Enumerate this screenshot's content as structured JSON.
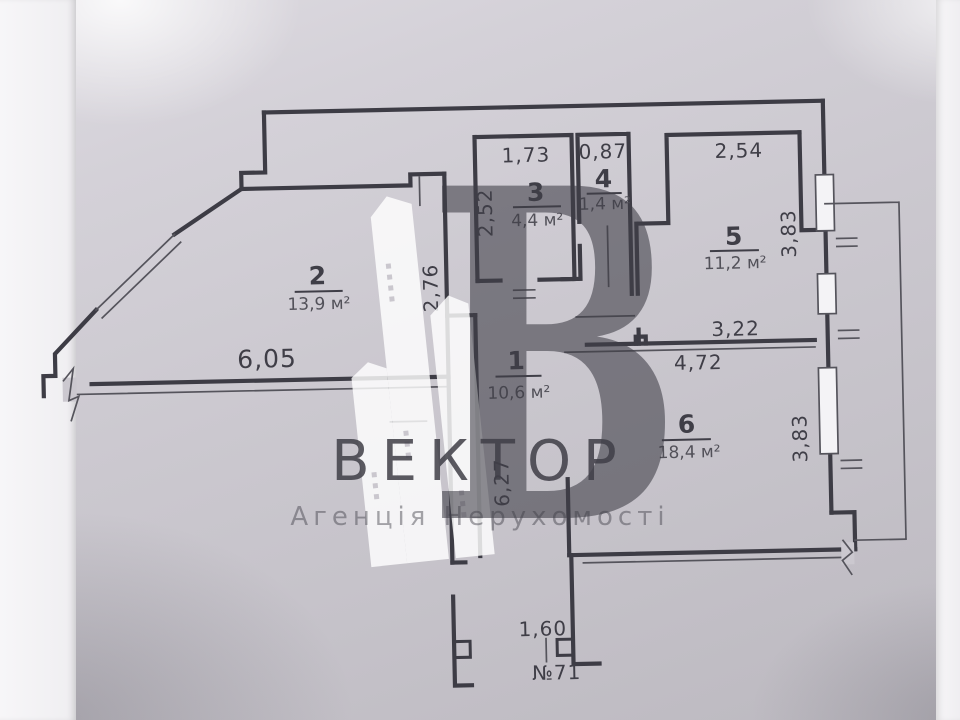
{
  "plan": {
    "apartment_label": "№71",
    "rooms": [
      {
        "number": "1",
        "area": "10,6 м²"
      },
      {
        "number": "2",
        "area": "13,9 м²"
      },
      {
        "number": "3",
        "area": "4,4 м²"
      },
      {
        "number": "4",
        "area": "1,4 м²"
      },
      {
        "number": "5",
        "area": "11,2 м²"
      },
      {
        "number": "6",
        "area": "18,4 м²"
      }
    ],
    "dimensions": {
      "room2_bottom_width": "6,05",
      "hall_top_length": "2,76",
      "room3_height": "2,52",
      "room3_width": "1,73",
      "room4_width": "0,87",
      "room5_width": "2,54",
      "room5_height": "3,83",
      "hall_to_room6": "3,22",
      "room6_width": "4,72",
      "room6_height": "3,83",
      "hall_length": "6,27",
      "entrance_width": "1,60"
    }
  },
  "watermark": {
    "logo_letter": "B",
    "brand": "ВЕКТОР",
    "tagline": "Агенція Нерухомості"
  },
  "colors": {
    "wall": "#3d3c45",
    "text": "#3f3e47",
    "area_text": "#525159",
    "paper": "#cbc8cf",
    "watermark": "#ffffff"
  }
}
